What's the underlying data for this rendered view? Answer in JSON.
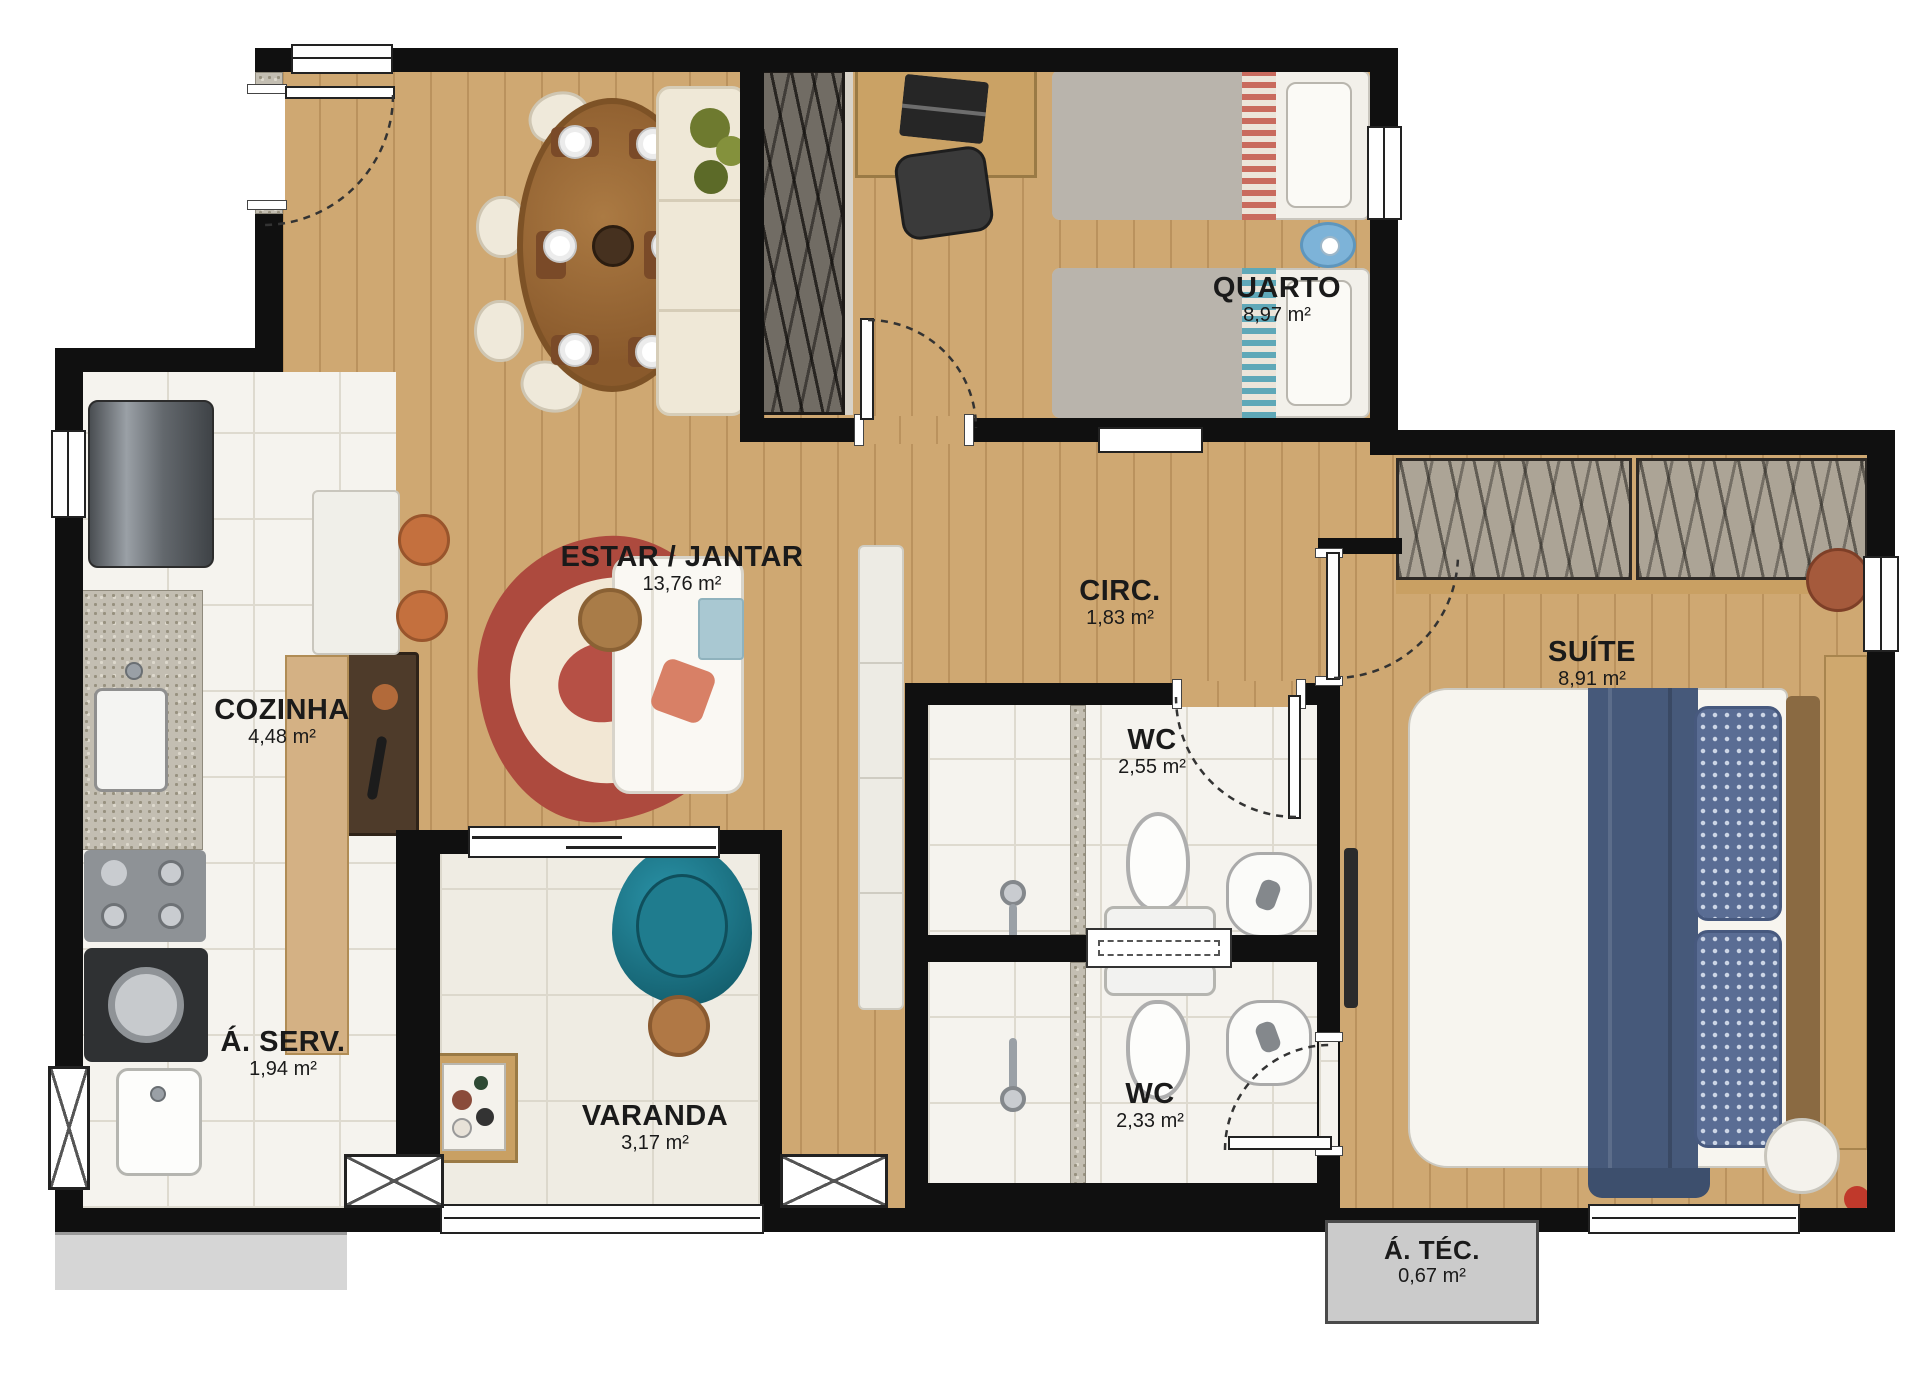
{
  "plan_title": "Apartment floor plan",
  "rooms": {
    "estar": {
      "label": "ESTAR / JANTAR",
      "area": "13,76 m²"
    },
    "quarto": {
      "label": "QUARTO",
      "area": "8,97 m²"
    },
    "circ": {
      "label": "CIRC.",
      "area": "1,83 m²"
    },
    "suite": {
      "label": "SUÍTE",
      "area": "8,91 m²"
    },
    "cozinha": {
      "label": "COZINHA",
      "area": "4,48 m²"
    },
    "wc1": {
      "label": "WC",
      "area": "2,55 m²"
    },
    "wc2": {
      "label": "WC",
      "area": "2,33 m²"
    },
    "aserv": {
      "label": "Á. SERV.",
      "area": "1,94 m²"
    },
    "varanda": {
      "label": "VARANDA",
      "area": "3,17 m²"
    },
    "atec": {
      "label": "Á. TÉC.",
      "area": "0,67 m²"
    }
  },
  "colors": {
    "wall": "#101010",
    "wood_floor": "#cfa872",
    "tile_floor": "#f5f3ee",
    "balcony_floor": "#efece3",
    "label_text": "#1a1a1a",
    "rug_outer": "#ad4a3e",
    "rug_inner": "#f2e7d4",
    "armchair_teal": "#1f8296",
    "chair_terracotta": "#c4703e",
    "blanket_blue": "#46597a",
    "bed_stripe_red": "#c96b5e",
    "bed_stripe_teal": "#5fa8b8",
    "sidewalk_gray": "#d6d6d6",
    "atec_gray": "#cbcbcb"
  }
}
